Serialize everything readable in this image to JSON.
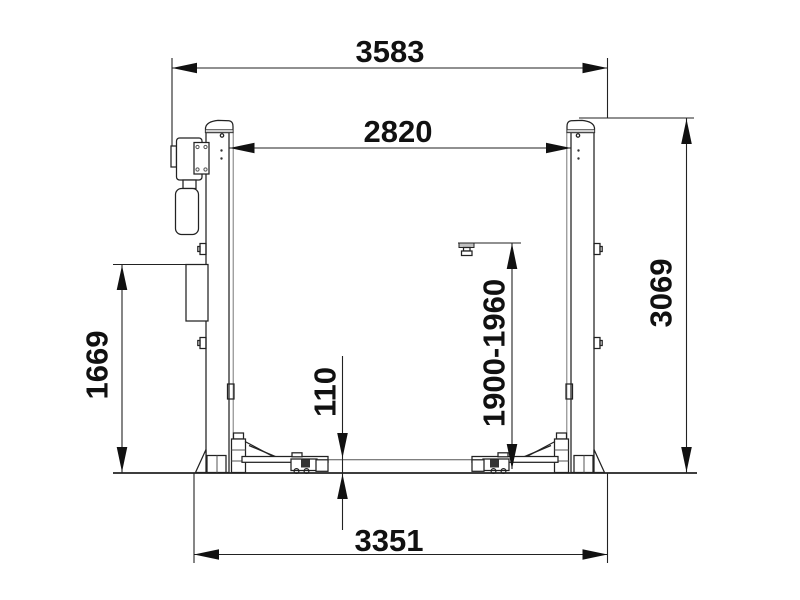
{
  "colors": {
    "line": "#222222",
    "background": "#ffffff",
    "cap_band": "#cfcfcf",
    "text": "#111111"
  },
  "dims": {
    "top_width": "3583",
    "inner_width": "2820",
    "right_height": "3069",
    "left_height": "1669",
    "lift_range": "1900-1960",
    "pad_height": "110",
    "base_width": "3351"
  }
}
